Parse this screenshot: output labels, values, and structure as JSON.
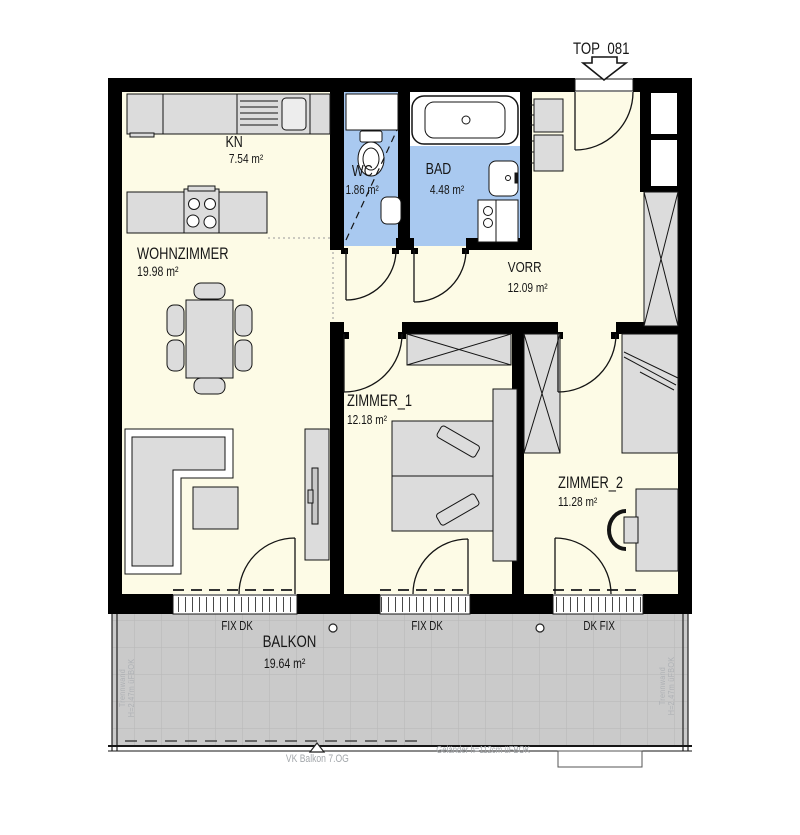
{
  "title": "TOP_081",
  "rooms": {
    "kn": {
      "name": "KN",
      "area": "7.54 m²"
    },
    "wohnzimmer": {
      "name": "WOHNZIMMER",
      "area": "19.98 m²"
    },
    "wc": {
      "name": "WC",
      "area": "1.86 m²"
    },
    "bad": {
      "name": "BAD",
      "area": "4.48 m²"
    },
    "vorr": {
      "name": "VORR",
      "area": "12.09 m²"
    },
    "zimmer1": {
      "name": "ZIMMER_1",
      "area": "12.18 m²"
    },
    "zimmer2": {
      "name": "ZIMMER_2",
      "area": "11.28 m²"
    },
    "balkon": {
      "name": "BALKON",
      "area": "19.64 m²"
    }
  },
  "windows": {
    "left": "FIX DK",
    "middle": "FIX DK",
    "right": "DK FIX"
  },
  "annotations": {
    "balcony_edge": "VK Balkon 7.OG",
    "railing": "Geländer h=112cm üFBOK",
    "partition_left_line1": "Trennwand",
    "partition_left_line2": "H=2,47m üFBOK",
    "partition_right_line1": "Trennwand",
    "partition_right_line2": "H=2,47m üFBOK"
  },
  "colors": {
    "floor": "#FDFBE6",
    "wet_rooms": "#A9C9F0",
    "balcony": "#CACACA",
    "furniture": "#DCDCDC",
    "wall": "#000000",
    "grid": "#B7B7B7",
    "annotation_gray": "#A3A7AB"
  }
}
